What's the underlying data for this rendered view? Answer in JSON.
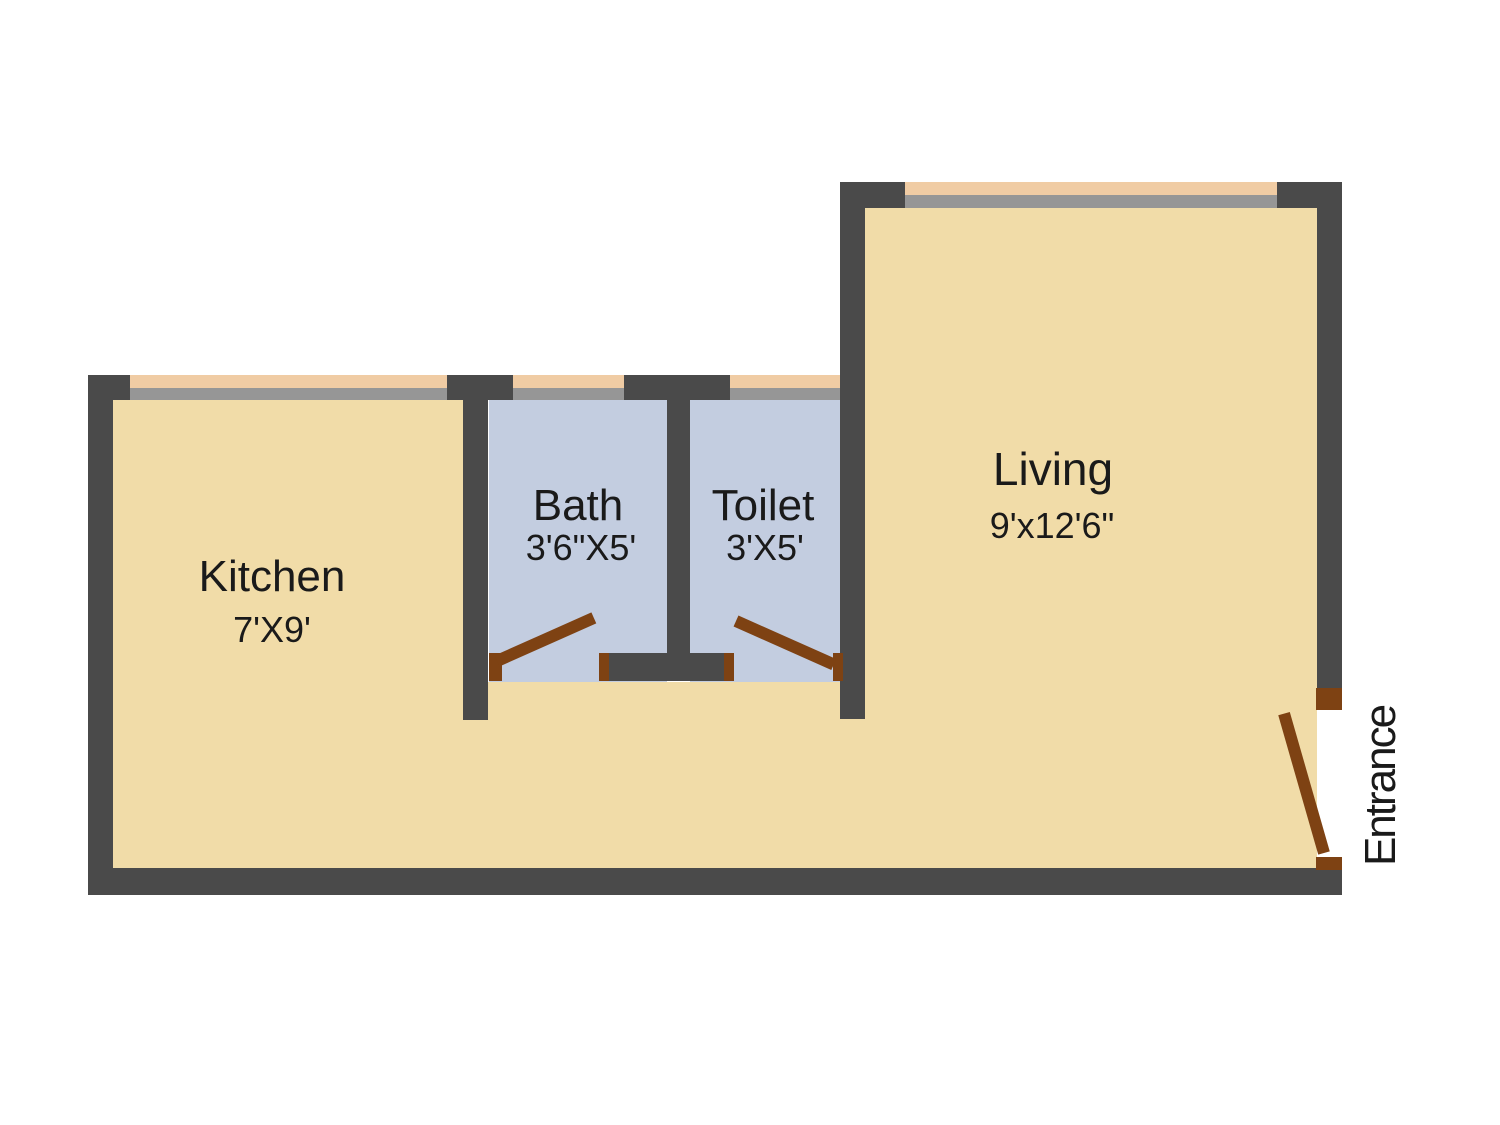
{
  "plan": {
    "title": "1 BHK floor plan",
    "colors": {
      "background": "#ffffff",
      "wall": "#4a4a4a",
      "floor_main": "#f1dca8",
      "floor_wet": "#c3cde0",
      "window_glass": "#f0cca4",
      "window_sill": "#969696",
      "door": "#7e4213",
      "text": "#1a1a1a"
    },
    "rooms": [
      {
        "id": "kitchen",
        "name": "Kitchen",
        "dimensions": "7'X9'"
      },
      {
        "id": "bath",
        "name": "Bath",
        "dimensions": "3'6\"X5'"
      },
      {
        "id": "toilet",
        "name": "Toilet",
        "dimensions": "3'X5'"
      },
      {
        "id": "living",
        "name": "Living",
        "dimensions": "9'x12'6\""
      }
    ],
    "entrance_label": "Entrance"
  }
}
